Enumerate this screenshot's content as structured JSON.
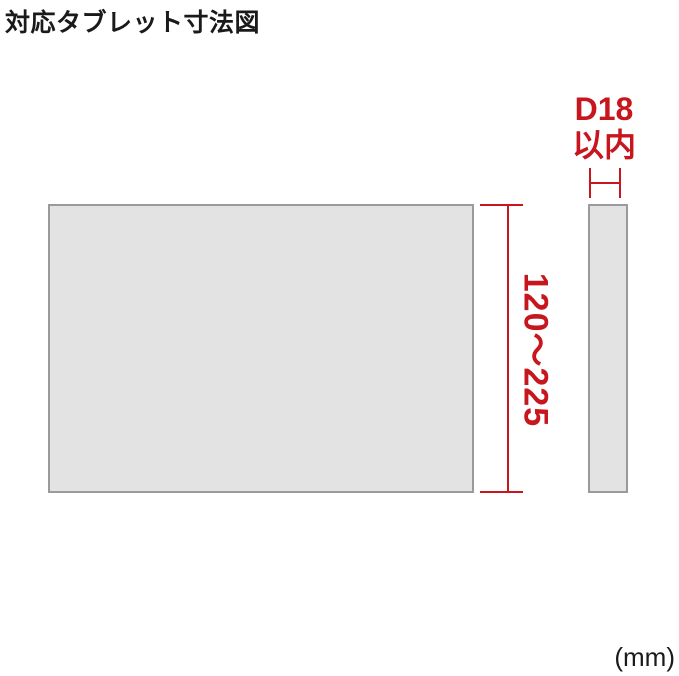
{
  "title": "対応タブレット寸法図",
  "dimensions": {
    "depth_value": "D18",
    "depth_qualifier": "以内",
    "height_range": "120～225",
    "unit": "(mm)"
  },
  "colors": {
    "dimension_red": "#c7161d",
    "tablet_fill": "#e3e3e3",
    "tablet_border": "#9a9a9a",
    "text_black": "#1a1a1a"
  }
}
